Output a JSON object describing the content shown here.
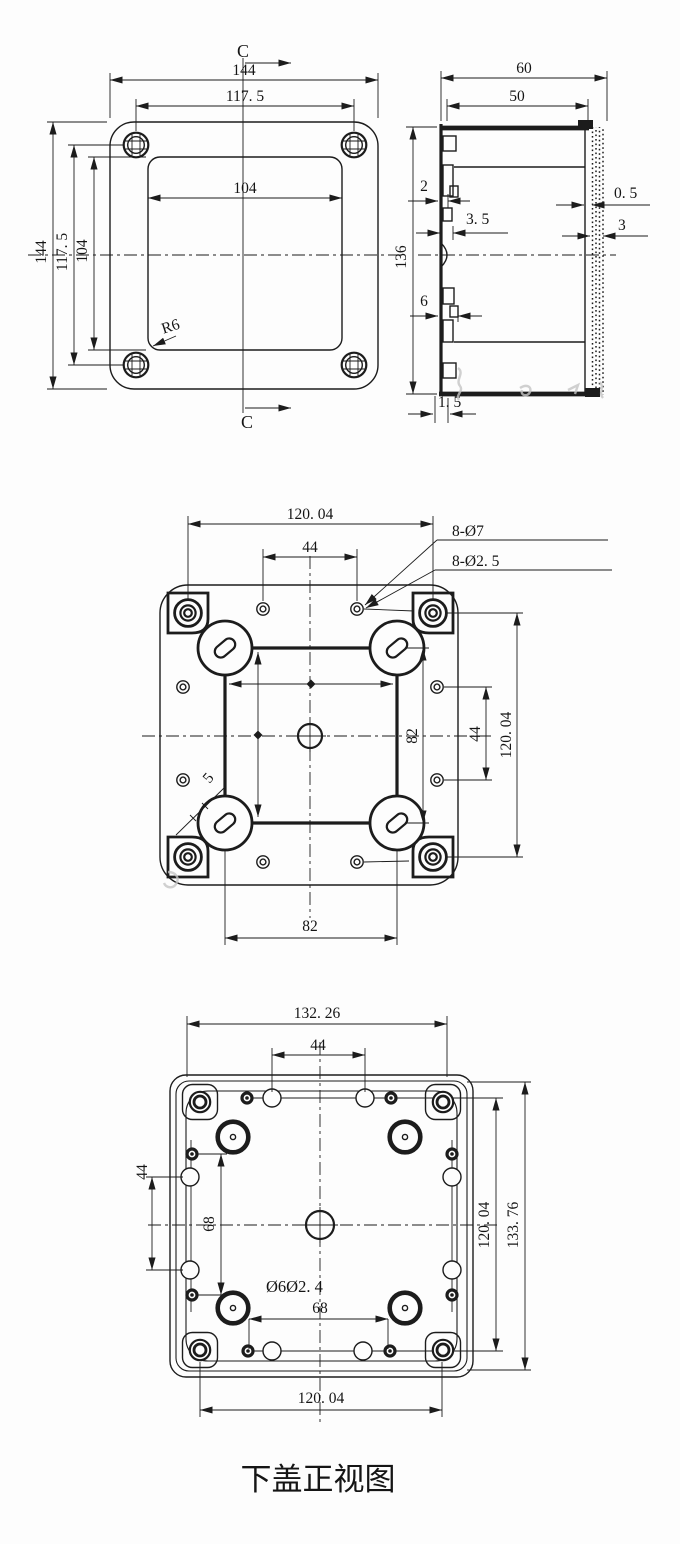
{
  "drawing": {
    "caption": "下盖正视图",
    "colors": {
      "line": "#1c1c1c",
      "background": "#fdfdfd",
      "watermark": "#c4c4c4"
    },
    "front_view": {
      "section_label": "C",
      "dim_overall_width": "144",
      "dim_screw_span_h": "117. 5",
      "dim_inner_width": "104",
      "dim_overall_height": "144",
      "dim_screw_span_v": "117. 5",
      "dim_inner_height": "104",
      "corner_radius": "R6"
    },
    "side_view": {
      "dim_overall_depth": "60",
      "dim_inner_depth": "50",
      "dim_wall": "2",
      "dim_latch_depth": "3. 5",
      "dim_gap": "0. 5",
      "dim_flange": "3",
      "dim_overall_height": "136",
      "dim_latch_width": "6",
      "dim_lip": "1. 5"
    },
    "inside_view": {
      "dim_mount_span_h": "120. 04",
      "dim_small_span_h": "44",
      "callout_large_holes": "8-Ø7",
      "callout_small_holes": "8-Ø2. 5",
      "dim_boss_span_v": "82",
      "dim_small_span_v": "44",
      "dim_mount_span_v": "120. 04",
      "dim_boss_span_h": "82",
      "dim_slot_width": "5"
    },
    "bottom_view": {
      "dim_overall_width": "132. 26",
      "dim_small_span_top": "44",
      "dim_small_span_left": "44",
      "dim_hole_span_left": "68",
      "callout_hole_dias": "Ø6Ø2. 4",
      "dim_hole_span_bottom": "68",
      "dim_mount_span_right": "120. 04",
      "dim_overall_height": "133. 76",
      "dim_mount_span_bottom": "120. 04"
    }
  }
}
